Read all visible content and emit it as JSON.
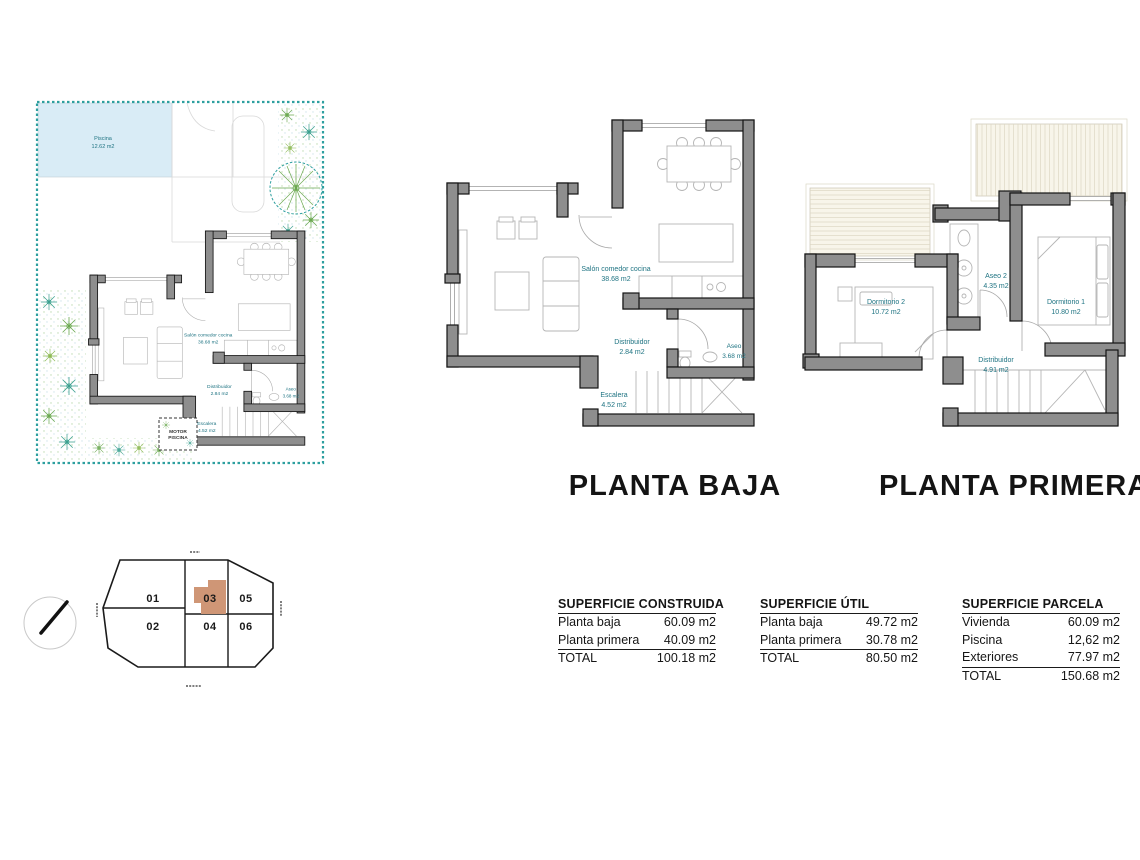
{
  "site_plan": {
    "pool": {
      "name": "Piscina",
      "area": "12.62 m2"
    },
    "motor_box": {
      "line1": "MOTOR",
      "line2": "PISCINA"
    }
  },
  "planta_baja": {
    "title": "PLANTA BAJA",
    "rooms": {
      "salon": {
        "name": "Salón comedor cocina",
        "area": "38.68 m2"
      },
      "distribuidor": {
        "name": "Distribuidor",
        "area": "2.84 m2"
      },
      "aseo": {
        "name": "Aseo",
        "area": "3.68 m2"
      },
      "escalera": {
        "name": "Escalera",
        "area": "4.52 m2"
      }
    }
  },
  "planta_primera": {
    "title": "PLANTA PRIMERA",
    "rooms": {
      "dormitorio2": {
        "name": "Dormitorio 2",
        "area": "10.72 m2"
      },
      "aseo2": {
        "name": "Aseo 2",
        "area": "4.35 m2"
      },
      "dormitorio1": {
        "name": "Dormitorio 1",
        "area": "10.80 m2"
      },
      "distribuidor": {
        "name": "Distribuidor",
        "area": "4.91 m2"
      }
    }
  },
  "key_plan": {
    "units": {
      "u01": "01",
      "u02": "02",
      "u03": "03",
      "u04": "04",
      "u05": "05",
      "u06": "06"
    },
    "highlighted_unit": "03"
  },
  "tables": {
    "construida": {
      "title": "SUPERFICIE CONSTRUIDA",
      "rows": [
        {
          "label": "Planta baja",
          "value": "60.09 m2"
        },
        {
          "label": "Planta primera",
          "value": "40.09 m2"
        }
      ],
      "total": {
        "label": "TOTAL",
        "value": "100.18 m2"
      }
    },
    "util": {
      "title": "SUPERFICIE ÚTIL",
      "rows": [
        {
          "label": "Planta baja",
          "value": "49.72 m2"
        },
        {
          "label": "Planta primera",
          "value": "30.78 m2"
        }
      ],
      "total": {
        "label": "TOTAL",
        "value": "80.50 m2"
      }
    },
    "parcela": {
      "title": "SUPERFICIE PARCELA",
      "rows": [
        {
          "label": "Vivienda",
          "value": "60.09 m2"
        },
        {
          "label": "Piscina",
          "value": "12,62 m2"
        },
        {
          "label": "Exteriores",
          "value": "77.97 m2"
        }
      ],
      "total": {
        "label": "TOTAL",
        "value": "150.68 m2"
      }
    }
  },
  "colors": {
    "label_teal": "#1e7382",
    "wall_gray": "#8e8e8e",
    "pool_blue": "#d9ecf6",
    "site_border_teal": "#2d9f9f",
    "highlight_tan": "#cf9676",
    "roof_cream": "#f8f5ea",
    "vegetation_green": "#6aa84f",
    "vegetation_teal": "#3aa08f"
  }
}
